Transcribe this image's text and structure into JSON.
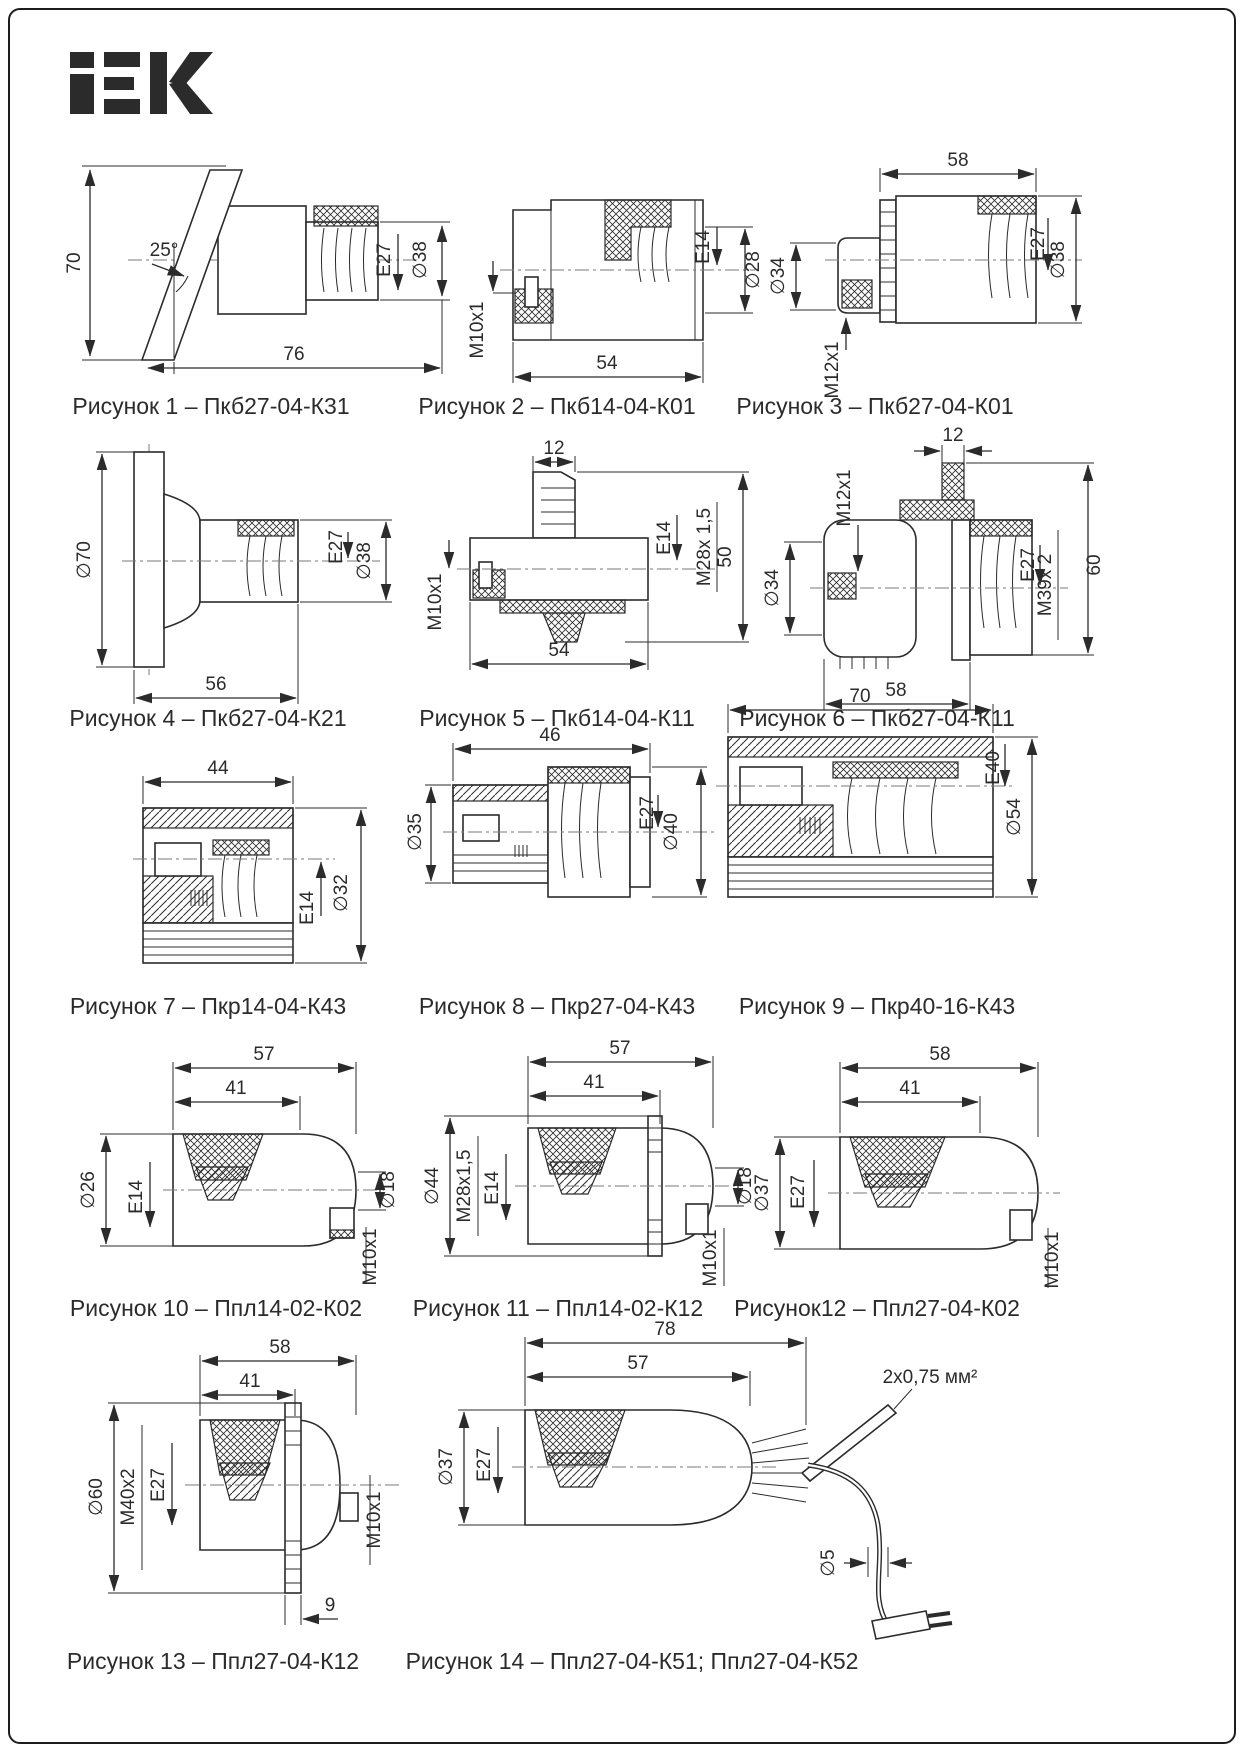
{
  "brand": {
    "name": "IEK"
  },
  "figures": [
    {
      "caption": "Рисунок 1 – Пкб27-04-К31",
      "dims": {
        "height": "70",
        "angle": "25°",
        "length": "76",
        "lamp": "E27",
        "dia": "∅38"
      }
    },
    {
      "caption": "Рисунок 2 – Пкб14-04-К01",
      "dims": {
        "gland": "M10x1",
        "length": "54",
        "lamp": "E14",
        "dia": "∅28"
      }
    },
    {
      "caption": "Рисунок 3 – Пкб27-04-К01",
      "dims": {
        "length": "58",
        "body_dia": "∅34",
        "gland": "M12x1",
        "lamp": "E27",
        "dia": "∅38"
      }
    },
    {
      "caption": "Рисунок 4 – Пкб27-04-К21",
      "dims": {
        "flange_dia": "∅70",
        "lamp": "E27",
        "dia": "∅38",
        "length": "56"
      }
    },
    {
      "caption": "Рисунок 5 – Пкб14-04-К11",
      "dims": {
        "boss": "12",
        "gland": "M10x1",
        "lamp": "E14",
        "mount": "M28x 1,5",
        "height": "50",
        "length": "54"
      }
    },
    {
      "caption": "Рисунок 6 – Пкб27-04-К11",
      "dims": {
        "gland": "M12x1",
        "boss": "12",
        "body_dia": "∅34",
        "lamp": "E27",
        "mount": "M39x 2",
        "height": "60",
        "length": "58"
      }
    },
    {
      "caption": "Рисунок 7 – Пкр14-04-К43",
      "dims": {
        "length": "44",
        "lamp": "E14",
        "dia": "∅32"
      }
    },
    {
      "caption": "Рисунок 8 – Пкр27-04-К43",
      "dims": {
        "length": "46",
        "body_dia": "∅35",
        "lamp": "E27",
        "dia": "∅40"
      }
    },
    {
      "caption": "Рисунок 9 – Пкр40-16-К43",
      "dims": {
        "length": "70",
        "lamp": "E40",
        "dia": "∅54"
      }
    },
    {
      "caption": "Рисунок 10 – Ппл14-02-К02",
      "dims": {
        "length": "57",
        "body_len": "41",
        "dia": "∅26",
        "lamp": "E14",
        "hole_dia": "∅18",
        "nipple": "M10x1"
      }
    },
    {
      "caption": "Рисунок 11 – Ппл14-02-К12",
      "dims": {
        "length": "57",
        "body_len": "41",
        "dia": "∅44",
        "mount": "M28x1,5",
        "lamp": "E14",
        "hole_dia": "∅18",
        "nipple": "M10x1"
      }
    },
    {
      "caption": "Рисунок12 – Ппл27-04-К02",
      "dims": {
        "length": "58",
        "body_len": "41",
        "dia": "∅37",
        "lamp": "E27",
        "nipple": "M10x1"
      }
    },
    {
      "caption": "Рисунок 13 – Ппл27-04-К12",
      "dims": {
        "length": "58",
        "body_len": "41",
        "dia": "∅60",
        "mount": "M40x2",
        "lamp": "E27",
        "nipple": "M10x1",
        "offset": "9"
      }
    },
    {
      "caption": "Рисунок 14 – Ппл27-04-К51; Ппл27-04-К52",
      "dims": {
        "length": "78",
        "body_len": "57",
        "dia": "∅37",
        "lamp": "E27",
        "cord_dia": "∅5",
        "cord": "2x0,75 мм²"
      }
    }
  ]
}
